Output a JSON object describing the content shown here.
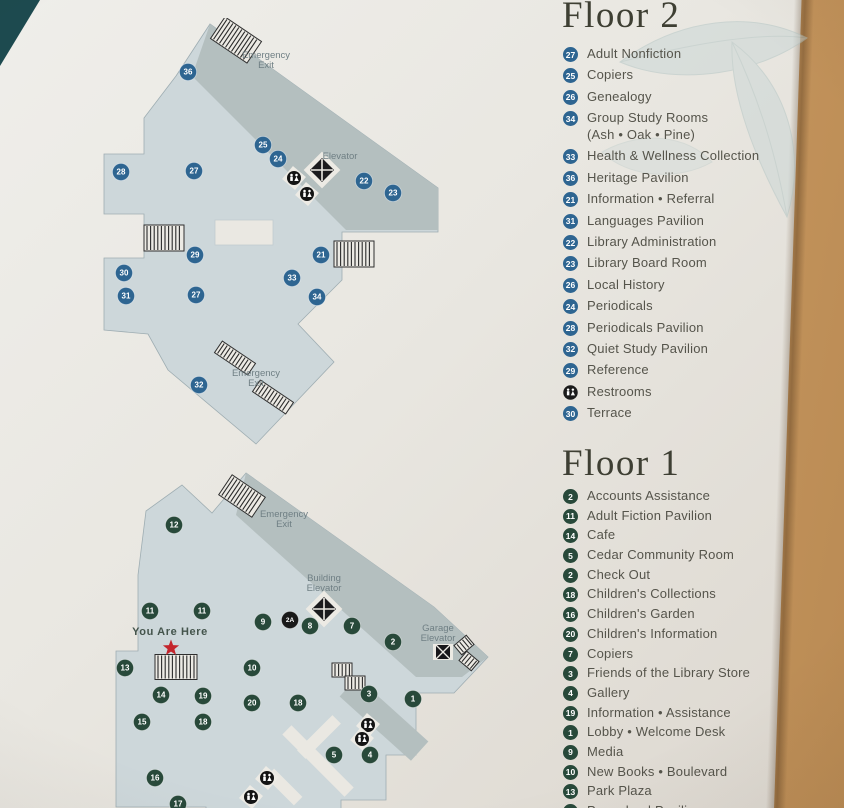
{
  "colors": {
    "floor2_marker": "#2e6591",
    "floor1_marker": "#28493a",
    "special_marker": "#191919",
    "map_light": "#cdd7da",
    "map_dark": "#b4bfbf",
    "map_white": "#eae8e2",
    "star_red": "#c4252c",
    "label_grey": "#6f7f84",
    "wall_tan": "#d2a168",
    "corner_teal": "#1d4a4f"
  },
  "floor2": {
    "title": "Floor 2",
    "legend": [
      {
        "n": "27",
        "label": "Adult Nonfiction"
      },
      {
        "n": "25",
        "label": "Copiers"
      },
      {
        "n": "26",
        "label": "Genealogy"
      },
      {
        "n": "34",
        "label": "Group Study Rooms",
        "sub": "(Ash • Oak • Pine)"
      },
      {
        "n": "33",
        "label": "Health & Wellness Collection"
      },
      {
        "n": "36",
        "label": "Heritage Pavilion"
      },
      {
        "n": "21",
        "label": "Information • Referral"
      },
      {
        "n": "31",
        "label": "Languages Pavilion"
      },
      {
        "n": "22",
        "label": "Library Administration"
      },
      {
        "n": "23",
        "label": "Library Board Room"
      },
      {
        "n": "26",
        "label": "Local History"
      },
      {
        "n": "24",
        "label": "Periodicals"
      },
      {
        "n": "28",
        "label": "Periodicals Pavilion"
      },
      {
        "n": "32",
        "label": "Quiet Study Pavilion"
      },
      {
        "n": "29",
        "label": "Reference"
      },
      {
        "icon": "restrooms",
        "label": "Restrooms"
      },
      {
        "n": "30",
        "label": "Terrace"
      }
    ],
    "map": {
      "markers": [
        {
          "n": "36",
          "x": 100,
          "y": 54
        },
        {
          "n": "25",
          "x": 175,
          "y": 127
        },
        {
          "n": "24",
          "x": 190,
          "y": 141
        },
        {
          "n": "22",
          "x": 276,
          "y": 163
        },
        {
          "n": "23",
          "x": 305,
          "y": 175
        },
        {
          "n": "28",
          "x": 33,
          "y": 154
        },
        {
          "n": "27",
          "x": 106,
          "y": 153
        },
        {
          "n": "29",
          "x": 107,
          "y": 237
        },
        {
          "n": "21",
          "x": 233,
          "y": 237
        },
        {
          "n": "30",
          "x": 36,
          "y": 255
        },
        {
          "n": "33",
          "x": 204,
          "y": 260
        },
        {
          "n": "31",
          "x": 38,
          "y": 278
        },
        {
          "n": "27",
          "x": 108,
          "y": 277
        },
        {
          "n": "34",
          "x": 229,
          "y": 279
        },
        {
          "n": "32",
          "x": 111,
          "y": 367
        }
      ],
      "labels": [
        {
          "t": "Emergency\nExit",
          "x": 178,
          "y": 40
        },
        {
          "t": "Elevator",
          "x": 252,
          "y": 141
        },
        {
          "t": "Emergency\nExit",
          "x": 168,
          "y": 358
        }
      ],
      "stairs": [
        {
          "x": 148,
          "y": 22,
          "w": 44,
          "h": 26,
          "r": 34
        },
        {
          "x": 76,
          "y": 220,
          "w": 40,
          "h": 26,
          "r": 0
        },
        {
          "x": 266,
          "y": 236,
          "w": 40,
          "h": 26,
          "r": 0
        },
        {
          "x": 147,
          "y": 340,
          "w": 40,
          "h": 14,
          "r": 34
        },
        {
          "x": 185,
          "y": 379,
          "w": 40,
          "h": 14,
          "r": 34
        }
      ],
      "elevators": [
        {
          "x": 234,
          "y": 152
        }
      ],
      "restrooms": [
        {
          "x": 206,
          "y": 160
        },
        {
          "x": 219,
          "y": 176
        }
      ]
    }
  },
  "floor1": {
    "title": "Floor 1",
    "legend": [
      {
        "n": "2",
        "label": "Accounts Assistance"
      },
      {
        "n": "11",
        "label": "Adult Fiction Pavilion"
      },
      {
        "n": "14",
        "label": "Cafe"
      },
      {
        "n": "5",
        "label": "Cedar Community Room"
      },
      {
        "n": "2",
        "label": "Check Out"
      },
      {
        "n": "18",
        "label": "Children's Collections"
      },
      {
        "n": "16",
        "label": "Children's Garden"
      },
      {
        "n": "20",
        "label": "Children's Information"
      },
      {
        "n": "7",
        "label": "Copiers"
      },
      {
        "n": "3",
        "label": "Friends of the Library Store"
      },
      {
        "n": "4",
        "label": "Gallery"
      },
      {
        "n": "19",
        "label": "Information • Assistance"
      },
      {
        "n": "1",
        "label": "Lobby • Welcome Desk"
      },
      {
        "n": "9",
        "label": "Media"
      },
      {
        "n": "10",
        "label": "New Books • Boulevard"
      },
      {
        "n": "13",
        "label": "Park Plaza"
      },
      {
        "n": "17",
        "label": "Pre-school Pavilion"
      }
    ],
    "map": {
      "markers": [
        {
          "n": "12",
          "x": 88,
          "y": 70
        },
        {
          "n": "11",
          "x": 64,
          "y": 156
        },
        {
          "n": "11",
          "x": 116,
          "y": 156
        },
        {
          "n": "9",
          "x": 177,
          "y": 167
        },
        {
          "n": "2A",
          "x": 204,
          "y": 165,
          "c": "special"
        },
        {
          "n": "8",
          "x": 224,
          "y": 171
        },
        {
          "n": "7",
          "x": 266,
          "y": 171
        },
        {
          "n": "2",
          "x": 307,
          "y": 187
        },
        {
          "n": "13",
          "x": 39,
          "y": 213
        },
        {
          "n": "10",
          "x": 166,
          "y": 213
        },
        {
          "n": "14",
          "x": 75,
          "y": 240
        },
        {
          "n": "19",
          "x": 117,
          "y": 241
        },
        {
          "n": "20",
          "x": 166,
          "y": 248
        },
        {
          "n": "18",
          "x": 212,
          "y": 248
        },
        {
          "n": "3",
          "x": 283,
          "y": 239
        },
        {
          "n": "1",
          "x": 327,
          "y": 244
        },
        {
          "n": "15",
          "x": 56,
          "y": 267
        },
        {
          "n": "18",
          "x": 117,
          "y": 267
        },
        {
          "n": "5",
          "x": 248,
          "y": 300
        },
        {
          "n": "4",
          "x": 284,
          "y": 300
        },
        {
          "n": "16",
          "x": 69,
          "y": 323
        },
        {
          "n": "17",
          "x": 92,
          "y": 349
        }
      ],
      "labels": [
        {
          "t": "Emergency\nExit",
          "x": 198,
          "y": 62
        },
        {
          "t": "Building\nElevator",
          "x": 238,
          "y": 126
        },
        {
          "t": "Garage\nElevator",
          "x": 352,
          "y": 176
        },
        {
          "t": "You Are Here",
          "x": 84,
          "y": 180,
          "cls": "yah"
        }
      ],
      "stairs": [
        {
          "x": 156,
          "y": 41,
          "w": 40,
          "h": 24,
          "r": 34
        },
        {
          "x": 90,
          "y": 212,
          "w": 42,
          "h": 25,
          "r": 0
        },
        {
          "x": 256,
          "y": 215,
          "w": 20,
          "h": 14,
          "r": 0
        },
        {
          "x": 269,
          "y": 228,
          "w": 20,
          "h": 14,
          "r": 0
        },
        {
          "x": 378,
          "y": 190,
          "w": 16,
          "h": 12,
          "r": -40
        },
        {
          "x": 383,
          "y": 206,
          "w": 16,
          "h": 12,
          "r": 40
        }
      ],
      "elevators": [
        {
          "x": 238,
          "y": 154
        }
      ],
      "garage_elevators": [
        {
          "x": 357,
          "y": 197
        }
      ],
      "restrooms": [
        {
          "x": 282,
          "y": 270
        },
        {
          "x": 276,
          "y": 284
        },
        {
          "x": 181,
          "y": 323
        },
        {
          "x": 165,
          "y": 342
        }
      ],
      "star": {
        "x": 85,
        "y": 193
      }
    }
  }
}
